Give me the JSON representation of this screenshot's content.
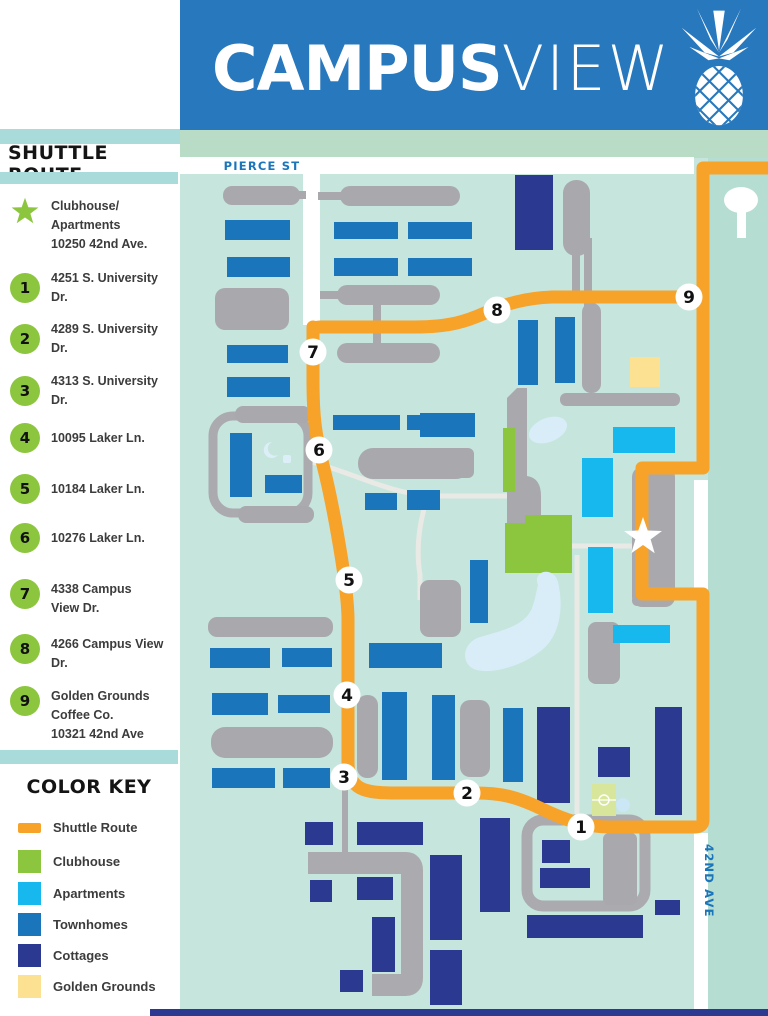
{
  "header": {
    "title_bold": "CAMPUS",
    "title_light": "VIEW",
    "logo": "pineapple-icon",
    "bg_color": "#2878BD"
  },
  "sidebar": {
    "shuttle_heading": "SHUTTLE ROUTE",
    "legend": [
      {
        "marker": "star",
        "lines": [
          "Clubhouse/",
          "Apartments",
          "10250 42nd Ave."
        ]
      },
      {
        "marker": "1",
        "lines": [
          "4251 S. University Dr."
        ]
      },
      {
        "marker": "2",
        "lines": [
          "4289 S. University Dr."
        ]
      },
      {
        "marker": "3",
        "lines": [
          "4313 S. University Dr."
        ]
      },
      {
        "marker": "4",
        "lines": [
          "10095 Laker Ln."
        ]
      },
      {
        "marker": "5",
        "lines": [
          "10184 Laker Ln."
        ]
      },
      {
        "marker": "6",
        "lines": [
          "10276 Laker Ln."
        ]
      },
      {
        "marker": "7",
        "lines": [
          "4338 Campus",
          "View Dr."
        ]
      },
      {
        "marker": "8",
        "lines": [
          "4266 Campus View",
          "Dr."
        ]
      },
      {
        "marker": "9",
        "lines": [
          "Golden Grounds",
          "Coffee Co.",
          "10321 42nd Ave"
        ]
      }
    ],
    "color_key_heading": "COLOR KEY",
    "color_key": [
      {
        "label": "Shuttle Route",
        "color": "#F7A229"
      },
      {
        "label": "Clubhouse",
        "color": "#8CC63E"
      },
      {
        "label": "Apartments",
        "color": "#17B8EE"
      },
      {
        "label": "Townhomes",
        "color": "#1B75BB"
      },
      {
        "label": "Cottages",
        "color": "#2B3990"
      },
      {
        "label": "Golden Grounds",
        "color": "#FBE191"
      }
    ]
  },
  "map": {
    "street_labels": {
      "pierce": "PIERCE ST",
      "avenue": "42ND AVE"
    },
    "stops": [
      "1",
      "2",
      "3",
      "4",
      "5",
      "6",
      "7",
      "8",
      "9"
    ],
    "colors": {
      "map_background": "#C6E5DD",
      "top_band": "#B9DCC6",
      "roads": "#FFFFFF",
      "shuttle_route": "#F7A229",
      "buildings_gray": "#A9A9AD",
      "pond": "#D9EDF8"
    }
  }
}
